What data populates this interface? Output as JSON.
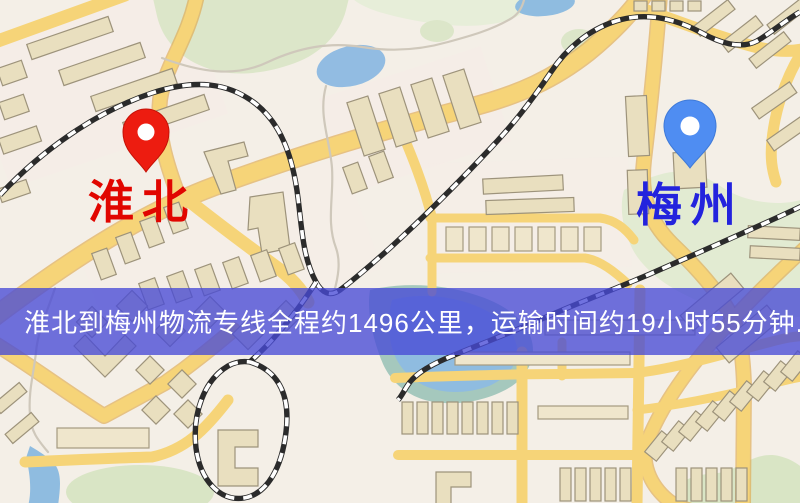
{
  "page": {
    "width": 800,
    "height": 503,
    "kind": "logistics-route-map"
  },
  "markers": {
    "origin": {
      "label": "淮北",
      "label_color": "#e10600",
      "pin_color": "#ed1c10"
    },
    "destination": {
      "label": "梅州",
      "label_color": "#2323dd",
      "pin_color": "#4f8df2"
    }
  },
  "route_banner": {
    "text": "淮北到梅州物流专线全程约1496公里，运输时间约19小时55分钟.",
    "origin": "淮北",
    "destination": "梅州",
    "distance_text": "1496公里",
    "duration_text": "19小时55分钟",
    "background_color": "#484ad6",
    "text_color": "#ffffff"
  },
  "map_palette": {
    "background": "#f4efe7",
    "road_fill": "#f6d478",
    "road_casing": "#dfa94e",
    "building": "#e9dfbf",
    "park": "#dce6c9",
    "water": "#8fbce0",
    "railway": "#2b2b2b"
  }
}
